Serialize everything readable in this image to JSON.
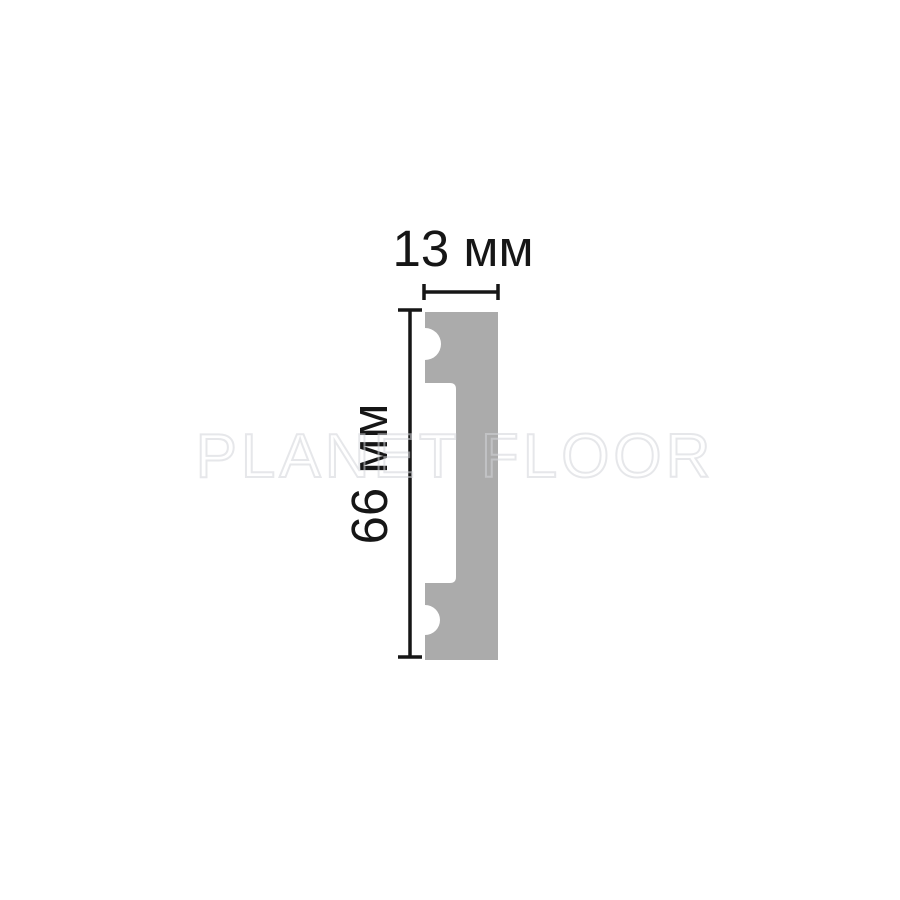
{
  "image": {
    "background_color": "#ffffff"
  },
  "watermark": {
    "text": "PLANET FLOOR",
    "stroke_color": "#d3d5da"
  },
  "diagram": {
    "width_label": "13 мм",
    "height_label": "66 мм",
    "width_mm": 13,
    "height_mm": 66,
    "profile_color": "#ababab",
    "line_color": "#161616"
  }
}
